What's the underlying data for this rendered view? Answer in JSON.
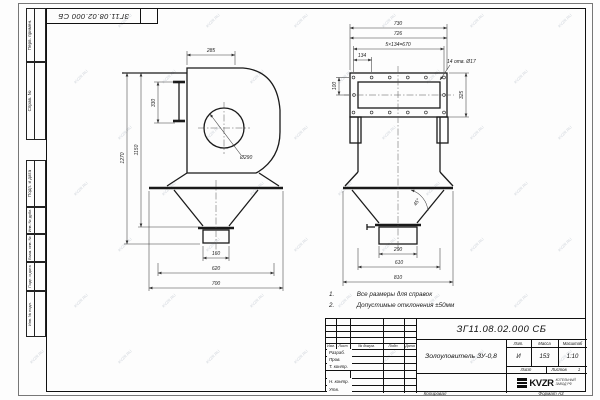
{
  "sheet": {
    "stamp_top": "ЗГ11.08.02.000 СБ",
    "watermark": "KVZR.RU",
    "frame_labels": [
      "Перв. примен.",
      "Справ. №",
      "Подп. и дата",
      "Инв. № дубл.",
      "Взам. инв. №",
      "Подп. и дата",
      "Инв. № подл."
    ]
  },
  "views": {
    "left": {
      "dims": {
        "top_width": "285",
        "inlet_height": "330",
        "body_height": "1150",
        "total_height": "1270",
        "inlet_dia": "Ø290",
        "outlet_width": "160",
        "cone_width": "620",
        "base_width": "700"
      }
    },
    "front": {
      "dims": {
        "overall_width": "730",
        "flange_width": "726",
        "hole_spacing": "5×134=670",
        "hole_pitch": "134",
        "holes_note": "14 отв. Ø17",
        "flange_left": "100",
        "flange_height": "325",
        "cone_angle": "45°",
        "outlet_width": "290",
        "cone_top": "610",
        "base_width": "810"
      }
    }
  },
  "notes": [
    {
      "num": "1.",
      "text": "Все размеры для справок"
    },
    {
      "num": "2.",
      "text": "Допустимые отклонения ±50мм"
    }
  ],
  "title_block": {
    "designation": "ЗГ11.08.02.000 СБ",
    "name": "Золоуловитель ЗУ-0,8",
    "header_cols": [
      "Изм.",
      "Лист",
      "№ докум.",
      "Подп.",
      "Дата"
    ],
    "rows": [
      "Разраб.",
      "Пров.",
      "Т. контр.",
      "Н. контр.",
      "Утв."
    ],
    "lit_label": "Лит.",
    "lit_value": "И",
    "mass_label": "Масса",
    "mass_value": "153",
    "scale_label": "Масштаб",
    "scale_value": "1:10",
    "sheet_label": "Лист",
    "sheets_label": "Листов",
    "sheets_value": "1",
    "logo_text": "KVZR",
    "logo_sub1": "КОТЕЛЬНЫЙ",
    "logo_sub2": "ЗАВОД РФ",
    "copied_label": "Копировал",
    "format_label": "Формат А3"
  }
}
